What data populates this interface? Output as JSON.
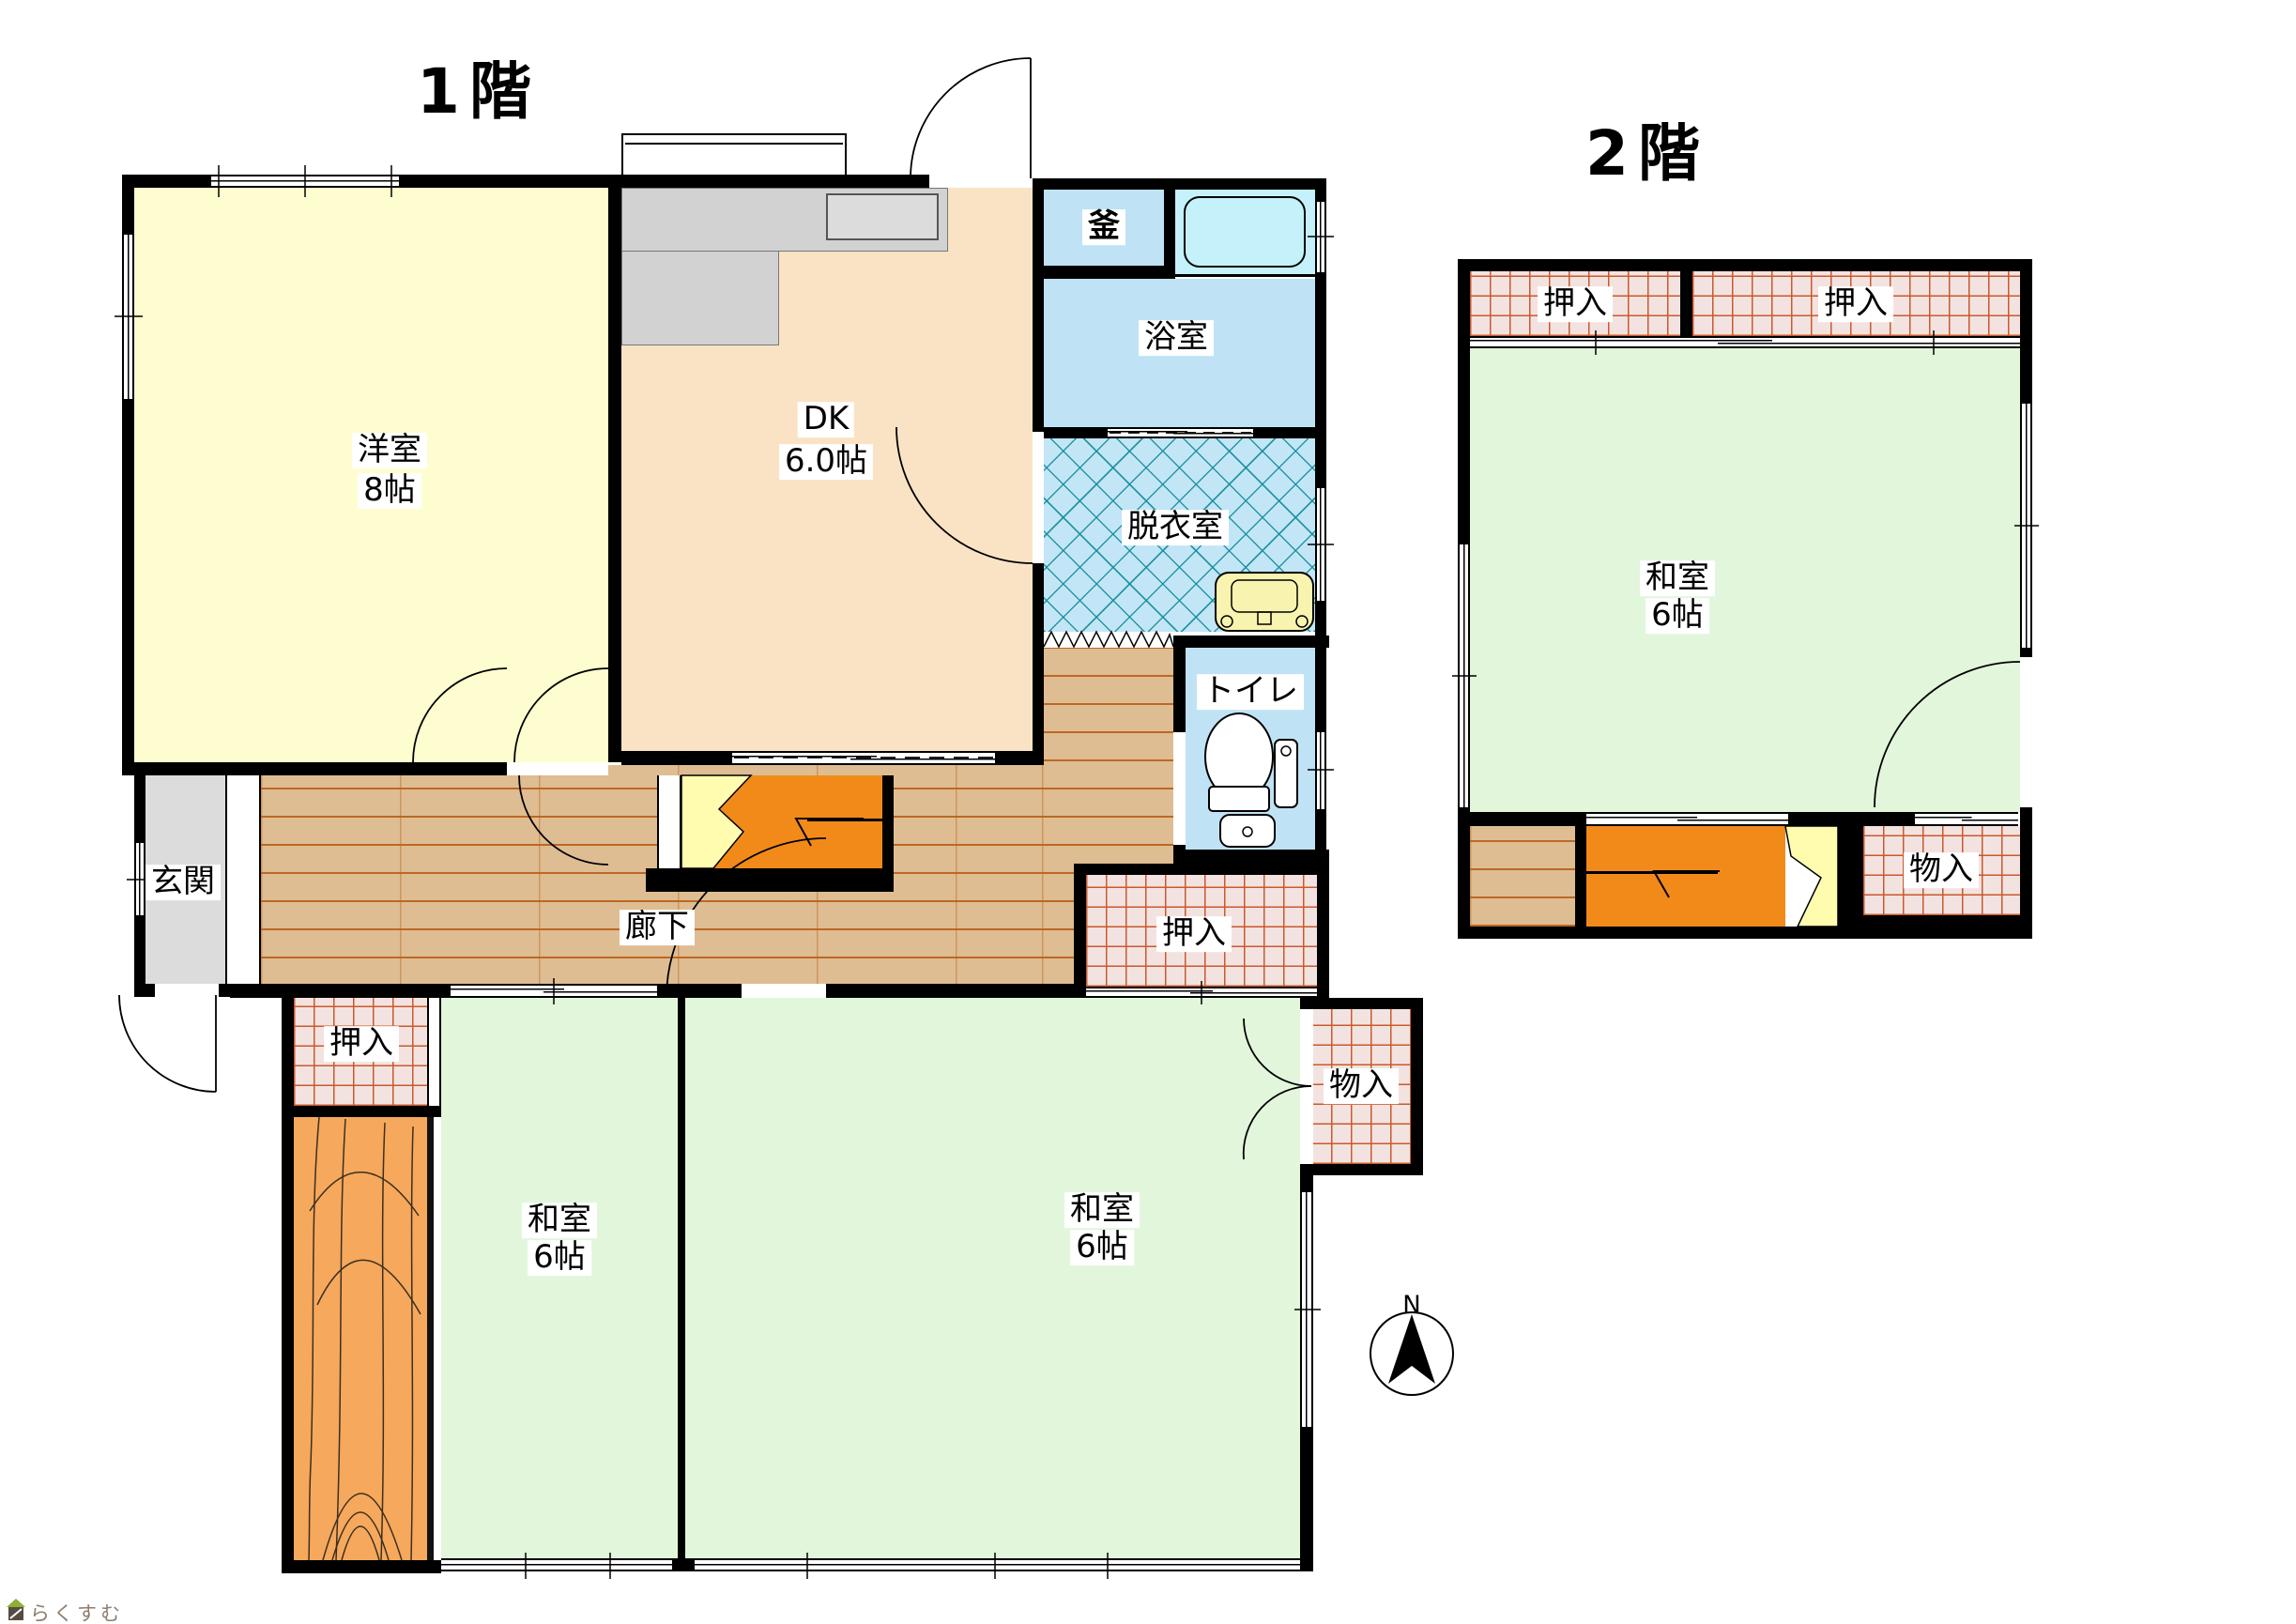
{
  "floor1": {
    "title": "1階",
    "rooms": {
      "yoshitsu": {
        "name": "洋室",
        "size": "8帖"
      },
      "dk": {
        "name": "DK",
        "size": "6.0帖"
      },
      "kama": {
        "name": "釜"
      },
      "bathroom": {
        "name": "浴室"
      },
      "dressing": {
        "name": "脱衣室"
      },
      "toilet": {
        "name": "トイレ"
      },
      "genkan": {
        "name": "玄関"
      },
      "corridor": {
        "name": "廊下"
      },
      "closet_hall": {
        "name": "押入"
      },
      "closet_west": {
        "name": "押入"
      },
      "washitsu_west": {
        "name": "和室",
        "size": "6帖"
      },
      "washitsu_east": {
        "name": "和室",
        "size": "6帖"
      },
      "storage": {
        "name": "物入"
      }
    }
  },
  "floor2": {
    "title": "2階",
    "rooms": {
      "closet_left": {
        "name": "押入"
      },
      "closet_right": {
        "name": "押入"
      },
      "washitsu": {
        "name": "和室",
        "size": "6帖"
      },
      "storage": {
        "name": "物入"
      }
    }
  },
  "compass": {
    "label": "N"
  },
  "watermark": {
    "text": "らくすむ"
  },
  "colors": {
    "western_room": "#FEFDD0",
    "dk": "#FAE3C4",
    "water_blue": "#BFE3F5",
    "bath_tub_room": "#C5F1FA",
    "tatami": "#E2F6DC",
    "wood_floor": "#DFBD92",
    "closet_bg": "#F3E3E0",
    "stairs": "#F28A1A",
    "stair_break": "#FFFCB0",
    "entrance": "#DCDCDC",
    "kitchen_counter": "#D2D2D2",
    "veranda": "#F6A85C",
    "wall": "#000000"
  }
}
